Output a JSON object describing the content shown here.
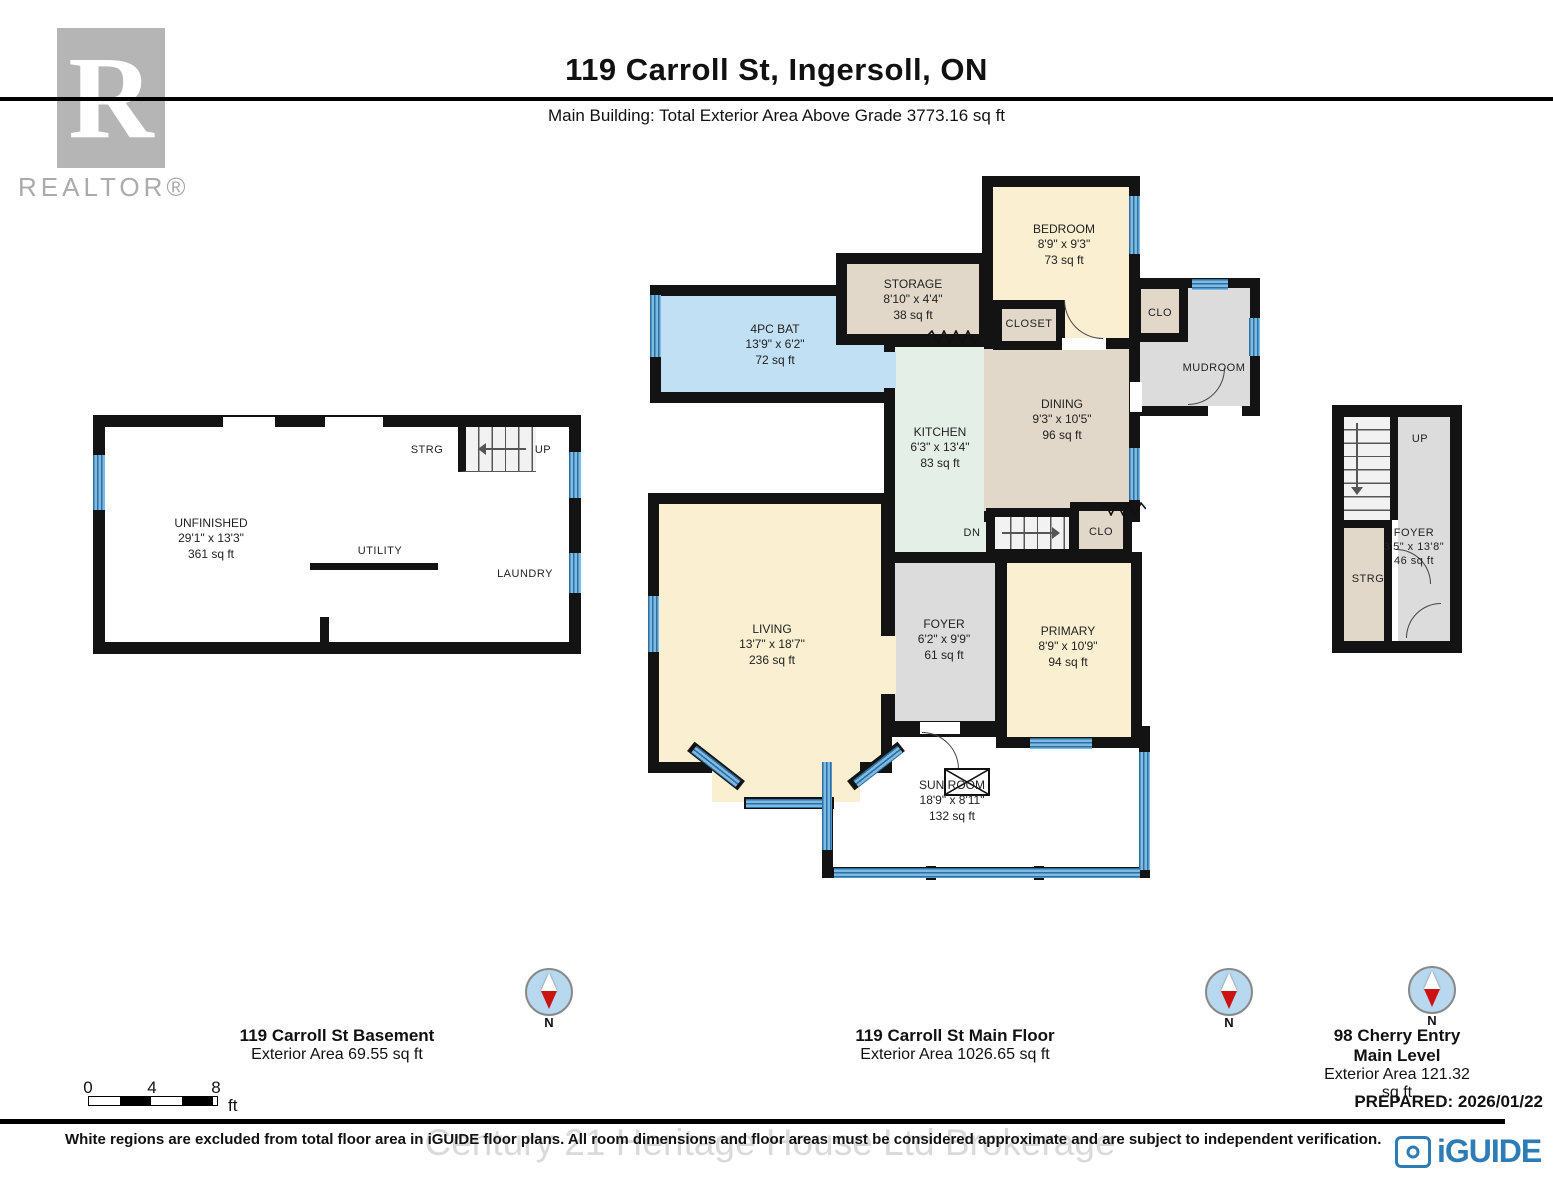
{
  "header": {
    "title": "119 Carroll St, Ingersoll, ON",
    "subtitle": "Main Building: Total Exterior Area Above Grade 3773.16 sq ft"
  },
  "branding": {
    "realtor": "REALTOR®",
    "realtor_r": "R"
  },
  "plans": {
    "basement": {
      "caption_title": "119 Carroll St Basement",
      "caption_area": "Exterior Area 69.55 sq ft",
      "rooms": {
        "unfinished": {
          "name": "UNFINISHED",
          "dims": "29'1\" x 13'3\"",
          "area": "361 sq ft"
        },
        "strg": {
          "name": "STRG"
        },
        "up": {
          "name": "UP"
        },
        "utility": {
          "name": "UTILITY"
        },
        "laundry": {
          "name": "LAUNDRY"
        }
      }
    },
    "main_floor": {
      "caption_title": "119 Carroll St Main Floor",
      "caption_area": "Exterior Area 1026.65 sq ft",
      "rooms": {
        "bath": {
          "name": "4PC BAT",
          "dims": "13'9\" x 6'2\"",
          "area": "72 sq ft"
        },
        "storage": {
          "name": "STORAGE",
          "dims": "8'10\" x 4'4\"",
          "area": "38 sq ft"
        },
        "bedroom": {
          "name": "BEDROOM",
          "dims": "8'9\" x 9'3\"",
          "area": "73 sq ft"
        },
        "closet": {
          "name": "CLOSET"
        },
        "clo_top": {
          "name": "CLO"
        },
        "mudroom": {
          "name": "MUDROOM"
        },
        "kitchen": {
          "name": "KITCHEN",
          "dims": "6'3\" x 13'4\"",
          "area": "83 sq ft"
        },
        "dining": {
          "name": "DINING",
          "dims": "9'3\" x 10'5\"",
          "area": "96 sq ft"
        },
        "dn": {
          "name": "DN"
        },
        "clo_mid": {
          "name": "CLO"
        },
        "living": {
          "name": "LIVING",
          "dims": "13'7\" x 18'7\"",
          "area": "236 sq ft"
        },
        "foyer": {
          "name": "FOYER",
          "dims": "6'2\" x 9'9\"",
          "area": "61 sq ft"
        },
        "primary": {
          "name": "PRIMARY",
          "dims": "8'9\" x 10'9\"",
          "area": "94 sq ft"
        },
        "sunroom": {
          "name": "SUN ROOM",
          "dims": "18'9\" x 8'11\"",
          "area": "132 sq ft"
        }
      }
    },
    "cherry_entry": {
      "caption_title": "98 Cherry Entry Main Level",
      "caption_area": "Exterior Area 121.32 sq ft",
      "rooms": {
        "up": {
          "name": "UP"
        },
        "foyer": {
          "name": "FOYER",
          "dims": "3'5\" x 13'8\"",
          "area": "46 sq ft"
        },
        "strg": {
          "name": "STRG"
        }
      }
    }
  },
  "compass": {
    "label": "N"
  },
  "scale_bar": {
    "ticks": [
      "0",
      "4",
      "8"
    ],
    "unit": "ft"
  },
  "footer": {
    "prepared": "PREPARED: 2026/01/22",
    "disclaimer": "White regions are excluded from total floor area in iGUIDE floor plans. All room dimensions and floor areas must be considered approximate and are subject to independent verification.",
    "watermark": "Century 21 Heritage House Ltd Brokerage",
    "logo_text": "iGUIDE"
  },
  "colors": {
    "wall": "#131313",
    "cream": "#faf0d1",
    "tan": "#e2d8c9",
    "bath": "#c2e0f4",
    "kitchen": "#e4efe8",
    "gray": "#dcdcdc",
    "iguide": "#2e7cb5",
    "compass_fill": "#b7d8ef",
    "needle_red": "#cc1111"
  }
}
